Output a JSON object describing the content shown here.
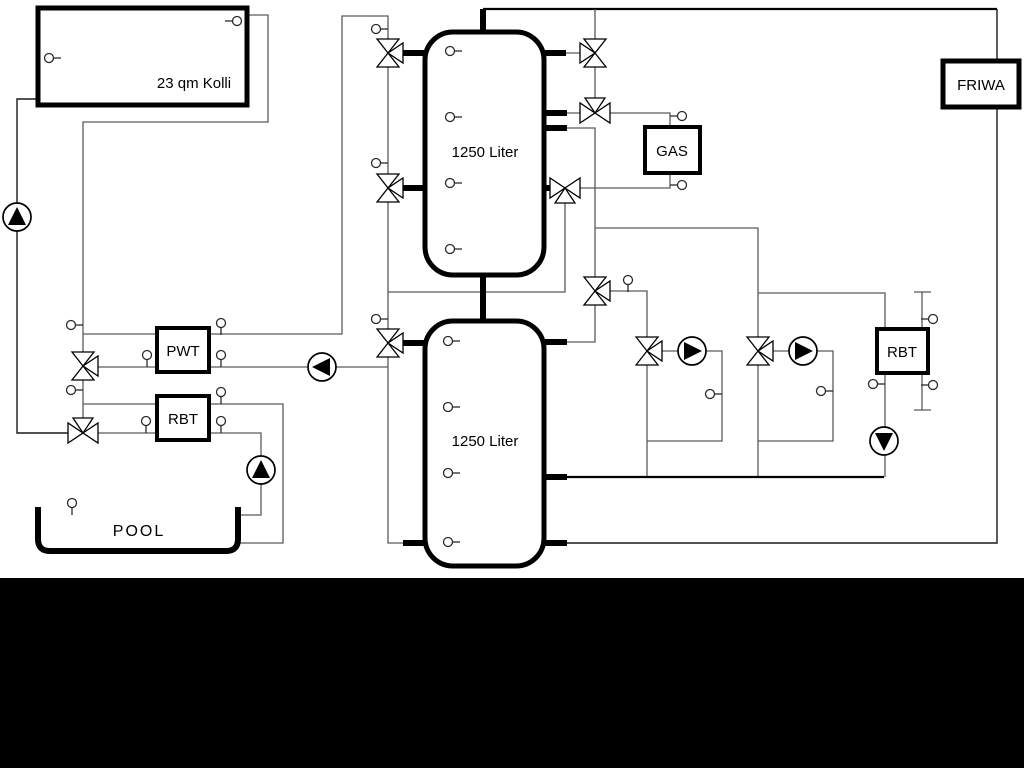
{
  "diagram": {
    "collector": {
      "label": "23 qm Kolli"
    },
    "tank1": {
      "label": "1250 Liter"
    },
    "tank2": {
      "label": "1250 Liter"
    },
    "gas": {
      "label": "GAS"
    },
    "friwa": {
      "label": "FRIWA"
    },
    "pwt": {
      "label": "PWT"
    },
    "rbt_left": {
      "label": "RBT"
    },
    "rbt_right": {
      "label": "RBT"
    },
    "pool": {
      "label": "POOL"
    }
  }
}
